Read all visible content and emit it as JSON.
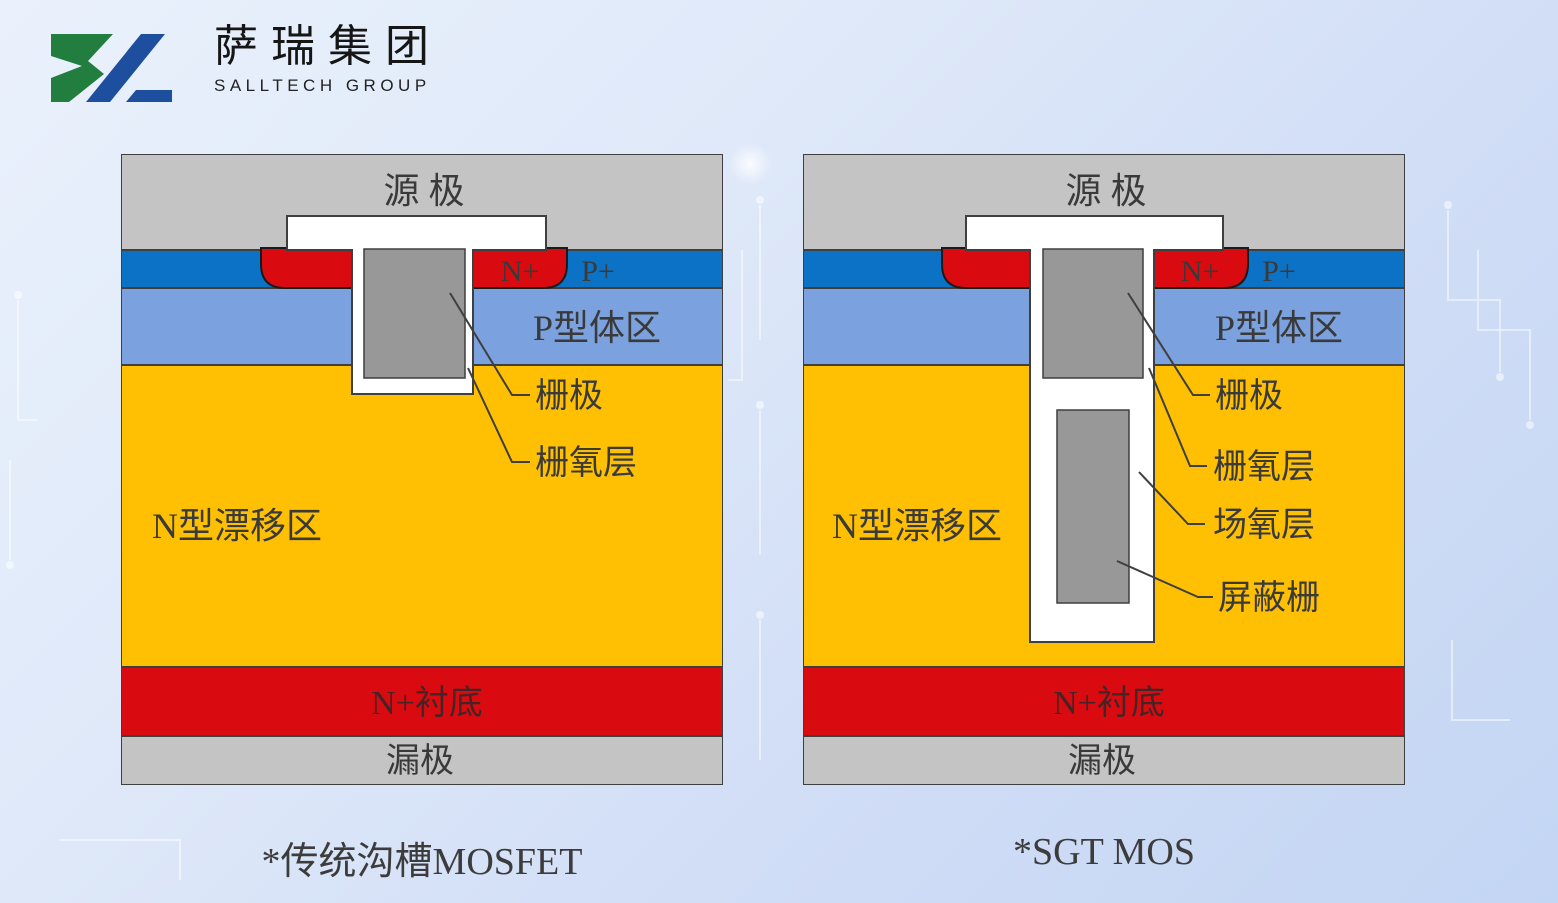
{
  "logo": {
    "company_cn": "萨瑞集团",
    "company_en": "SALLTECH GROUP"
  },
  "diagram_left": {
    "caption": "*传统沟槽MOSFET",
    "source": "源 极",
    "n_plus": "N+",
    "p_plus": "P+",
    "p_body": "P型体区",
    "n_drift": "N型漂移区",
    "substrate": "N+衬底",
    "drain": "漏极",
    "callout_gate": "栅极",
    "callout_gate_oxide": "栅氧层"
  },
  "diagram_right": {
    "caption": "*SGT MOS",
    "source": "源 极",
    "n_plus": "N+",
    "p_plus": "P+",
    "p_body": "P型体区",
    "n_drift": "N型漂移区",
    "substrate": "N+衬底",
    "drain": "漏极",
    "callout_gate": "栅极",
    "callout_gate_oxide": "栅氧层",
    "callout_field_oxide": "场氧层",
    "callout_shield_gate": "屏蔽栅"
  },
  "colors": {
    "metal_gray": "#c4c4c4",
    "n_source_blue": "#0b72c5",
    "p_body_blue": "#7ba2df",
    "n_drift_yellow": "#ffc003",
    "substrate_red": "#da0b10",
    "gate_poly_gray": "#989898",
    "outline": "#3f3f3f",
    "logo_green": "#217e3e",
    "logo_blue": "#1d4f9e",
    "background_top": "#eaf1fc",
    "background_bottom": "#c3d6f3"
  }
}
